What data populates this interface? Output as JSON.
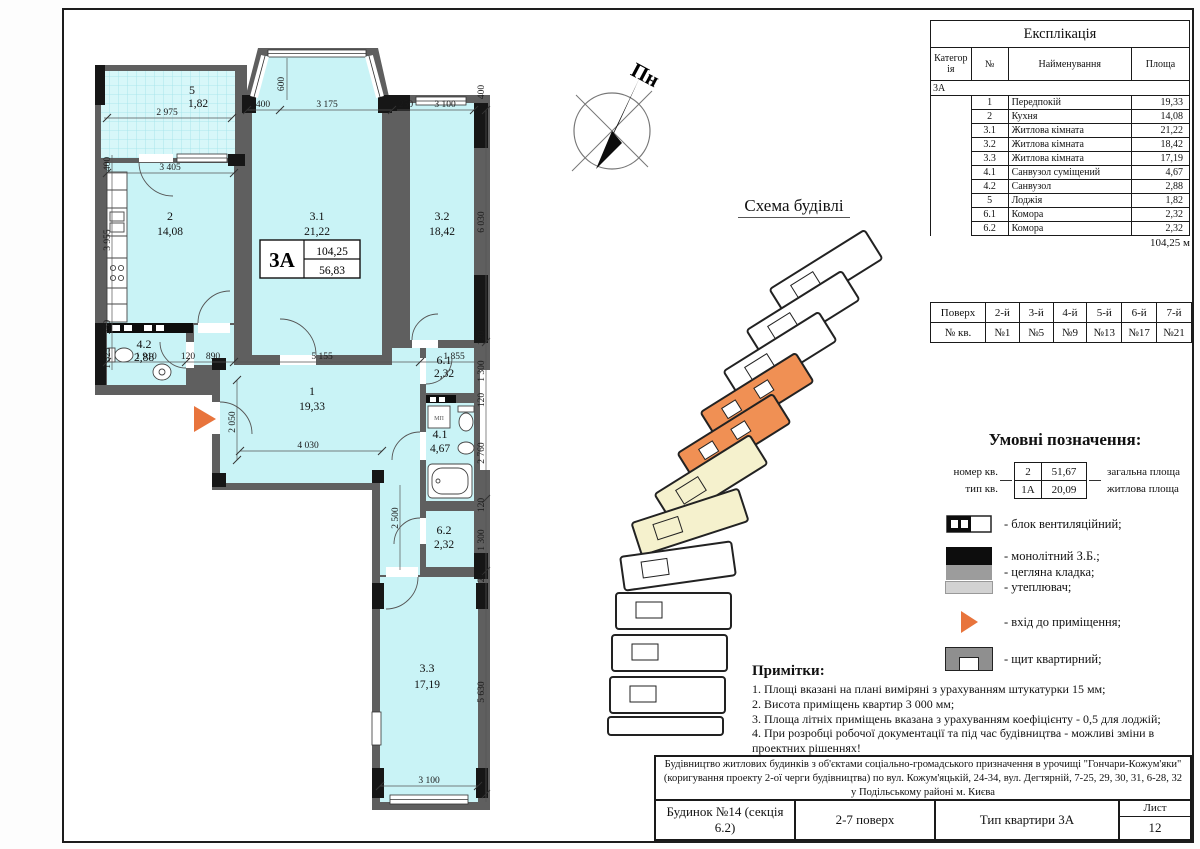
{
  "colors": {
    "room_fill": "#c9f3f6",
    "wall_gray": "#5f5f5f",
    "accent_orange": "#e8743c",
    "scheme_orange": "#f09054",
    "scheme_yellow": "#f5f1cd"
  },
  "plan": {
    "rooms": [
      {
        "number": "5",
        "area": "1,82"
      },
      {
        "number": "2",
        "area": "14,08"
      },
      {
        "number": "3.1",
        "area": "21,22"
      },
      {
        "number": "3.2",
        "area": "18,42"
      },
      {
        "number": "4.2",
        "area": "2,88"
      },
      {
        "number": "1",
        "area": "19,33"
      },
      {
        "number": "6.1",
        "area": "2,32"
      },
      {
        "number": "4.1",
        "area": "4,67"
      },
      {
        "number": "6.2",
        "area": "2,32"
      },
      {
        "number": "3.3",
        "area": "17,19"
      }
    ],
    "stamp": {
      "type": "3А",
      "total_area": "104,25",
      "living_area": "56,83"
    },
    "washing_machine_label": "МП",
    "dims": {
      "d2975": "2 975",
      "d400a": "400",
      "d3175": "3 175",
      "d600": "600",
      "d250a": "250",
      "d3100a": "3 100",
      "d400b": "400",
      "d400c": "400",
      "d3405": "3 405",
      "d3955": "3 955",
      "d250b": "250",
      "d1525": "1 525",
      "d1910": "1 910",
      "d120b": "120",
      "d890": "890",
      "d5155": "5 155",
      "d1855": "1 855",
      "d6030": "6 030",
      "d120a": "120",
      "d1300a": "1 300",
      "d120c": "120",
      "d2760": "2 760",
      "d120d": "120",
      "d1300b": "1 300",
      "d120e": "120",
      "d5630": "5 630",
      "d2050": "2 050",
      "d4030": "4 030",
      "d2500": "2 500",
      "d3100b": "3 100"
    }
  },
  "compass": {
    "label": "Пн"
  },
  "scheme": {
    "title": "Схема будівлі"
  },
  "explication": {
    "title": "Експлікація",
    "col_category": "Категорія",
    "col_no": "№",
    "col_name": "Найменування",
    "col_area": "Площа",
    "category": "3А",
    "rows": [
      [
        "1",
        "Передпокій",
        "19,33"
      ],
      [
        "2",
        "Кухня",
        "14,08"
      ],
      [
        "3.1",
        "Житлова кімната",
        "21,22"
      ],
      [
        "3.2",
        "Житлова кімната",
        "18,42"
      ],
      [
        "3.3",
        "Житлова кімната",
        "17,19"
      ],
      [
        "4.1",
        "Санвузол суміщений",
        "4,67"
      ],
      [
        "4.2",
        "Санвузол",
        "2,88"
      ],
      [
        "5",
        "Лоджія",
        "1,82"
      ],
      [
        "6.1",
        "Комора",
        "2,32"
      ],
      [
        "6.2",
        "Комора",
        "2,32"
      ]
    ],
    "total": "104,25 м"
  },
  "floors": {
    "rows": [
      [
        "Поверх",
        "2-й",
        "3-й",
        "4-й",
        "5-й",
        "6-й",
        "7-й"
      ],
      [
        "№ кв.",
        "№1",
        "№5",
        "№9",
        "№13",
        "№17",
        "№21"
      ]
    ]
  },
  "legend": {
    "title": "Умовні позначення:",
    "sample": {
      "row1_label": "номер кв.",
      "row2_label": "тип кв.",
      "cell_no": "2",
      "cell_total": "51,67",
      "cell_type": "1А",
      "cell_living": "20,09",
      "right1": "загальна площа",
      "right2": "житлова площа"
    },
    "items": [
      {
        "name": "vent-block",
        "label": "- блок вентиляційний;"
      },
      {
        "name": "monolithic",
        "label": "- монолітний З.Б.;"
      },
      {
        "name": "brick",
        "label": "- цегляна кладка;"
      },
      {
        "name": "insulation",
        "label": "- утеплювач;"
      },
      {
        "name": "entrance",
        "label": "- вхід до приміщення;"
      },
      {
        "name": "panel",
        "label": "- щит квартирний;"
      }
    ]
  },
  "notes": {
    "title": "Примітки:",
    "lines": [
      "1. Площі вказані на плані виміряні з урахуванням штукатурки 15 мм;",
      "2. Висота приміщень квартир 3 000 мм;",
      "3. Площа літніх приміщень вказана з урахуванням коефіцієнту - 0,5 для лоджій;",
      "4. При розробці робочої документації та під час будівництва - можливі зміни в проектних рішеннях!"
    ]
  },
  "title_block": {
    "project": "Будівництво житлових будинків з об'єктами соціально-громадського призначення в урочищі \"Гончари-Кожум'яки\" (коригування проекту 2-ої черги будівництва) по вул. Кожум'яцькій, 24-34, вул. Дегтярній, 7-25, 29, 30, 31, 6-28, 32 у Подільському районі м. Києва",
    "building": "Будинок №14 (секція 6.2)",
    "floors": "2-7 поверх",
    "apartment_type": "Тип квартири 3А",
    "sheet_label": "Лист",
    "sheet_number": "12"
  }
}
